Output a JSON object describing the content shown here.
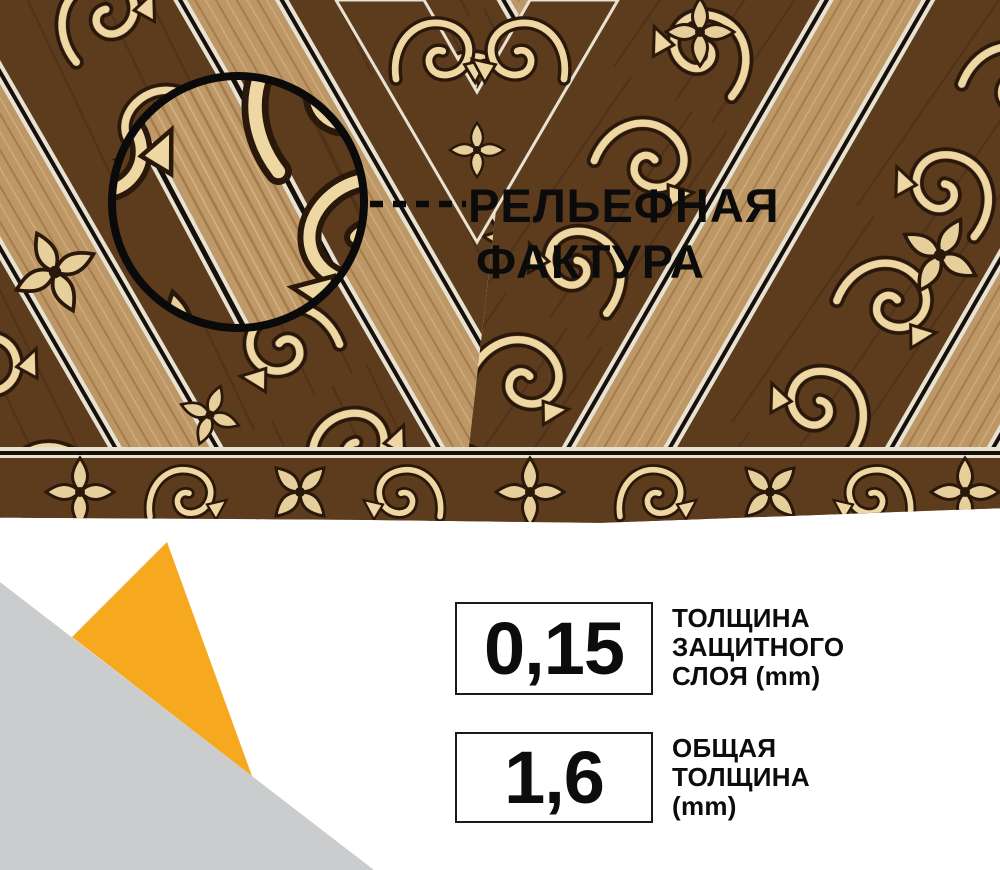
{
  "photo": {
    "description": "Ornamental brown linoleum flooring with gold scroll pattern, magnifier circle showing relief texture",
    "texture_note": {
      "line1": "РЕЛЬЕФНАЯ",
      "line2": "ФАКТУРА"
    }
  },
  "specs": [
    {
      "value": "0,15",
      "label_lines": [
        "ТОЛЩИНА",
        "ЗАЩИТНОГО",
        "СЛОЯ (mm)"
      ]
    },
    {
      "value": "1,6",
      "label_lines": [
        "ОБЩАЯ",
        "ТОЛЩИНА",
        "(mm)"
      ]
    }
  ],
  "icons": {
    "magnifier": "black-circle-outline",
    "leader": "black-dashed-line",
    "accent_shape": "yellow-triangle",
    "corner_shape": "gray-diagonal-corner"
  },
  "colors": {
    "accent_yellow": "#F6A81F",
    "corner_gray": "#CACCCE",
    "headline_text": "#0B0B0B",
    "spec_text": "#0C0C0C",
    "box_border": "#1A1A1A",
    "box_bg": "#FFFFFF",
    "page_bg": "#FFFFFF"
  }
}
